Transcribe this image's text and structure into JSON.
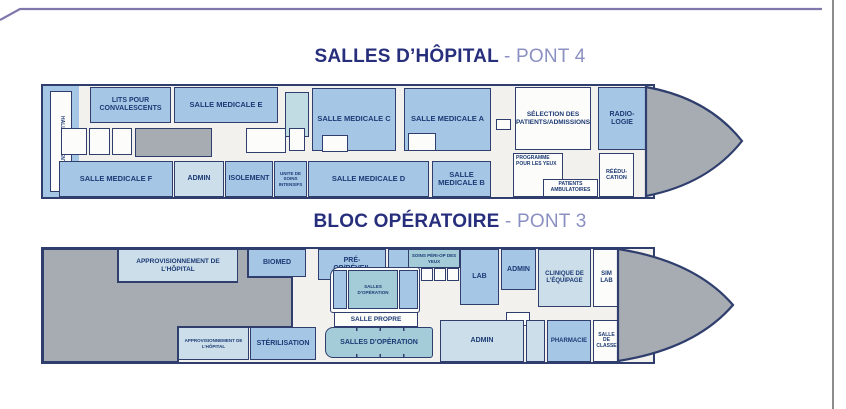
{
  "colors": {
    "room_blue": "#a6c6e6",
    "room_pale": "#cbdeea",
    "room_teal": "#a4ccd8",
    "room_white": "#fcfcfb",
    "hull_gray": "#a7acb3",
    "outline_navy": "#2f3e6d",
    "label_navy": "#1c3a74",
    "title_navy": "#272f7d",
    "title_light": "#8b90c2",
    "frame_purple": "#7f79ab",
    "frame_gray": "#8d8d8d"
  },
  "deck4": {
    "title": {
      "main": "SALLES D’HÔPITAL",
      "suffix": "- PONT 4"
    },
    "rooms": {
      "hall_des_patients": "HALL DES PATIENTS",
      "lits_pour_convalescents": "LITS POUR CONVALESCENTS",
      "salle_medicale_e": "SALLE MEDICALE E",
      "salle_medicale_c": "SALLE MEDICALE C",
      "salle_medicale_a": "SALLE MEDICALE A",
      "selection_admissions": "SÉLECTION DES PATIENTS/ADMISSIONS",
      "radiologie": "RADIO-LOGIE",
      "salle_medicale_f": "SALLE MEDICALE F",
      "admin": "ADMIN",
      "isolement": "ISOLEMENT",
      "unite_soins_intensifs": "UNITE DE SOINS INTENSIFS",
      "salle_medicale_d": "SALLE MEDICALE D",
      "salle_medicale_b": "SALLE MEDICALE B",
      "programme_yeux": "PROGRAMME POUR LES YEUX",
      "patients_ambulatoires": "PATIENTS AMBULATOIRES",
      "reeducation": "RÉÉDU-CATION"
    }
  },
  "deck3": {
    "title": {
      "main": "BLOC OPÉRATOIRE",
      "suffix": "- PONT 3"
    },
    "rooms": {
      "approvisionnement": "APPROVISIONNEMENT DE L’HÔPITAL",
      "biomed": "BIOMED",
      "pre_op_reveil": "PRÉ-OP/RÉVEIL",
      "soins_peri_op_yeux": "SOINS PÉRI-OP DES YEUX",
      "lab": "LAB",
      "admin_haut": "ADMIN",
      "clinique_equipage": "CLINIQUE DE L’ÉQUIPAGE",
      "sim_lab": "SIM LAB",
      "salles_operation_petit": "SALLES D’OPÉRATION",
      "salle_propre": "SALLE PROPRE",
      "approvisionnement_petit": "APPROVISIONNEMENT DE L’HÔPITAL",
      "sterilisation": "STÉRILISATION",
      "salles_operation": "SALLES D’OPÉRATION",
      "admin_bas": "ADMIN",
      "pharmacie": "PHARMACIE",
      "salle_de_classe": "SALLE DE CLASSE"
    }
  }
}
